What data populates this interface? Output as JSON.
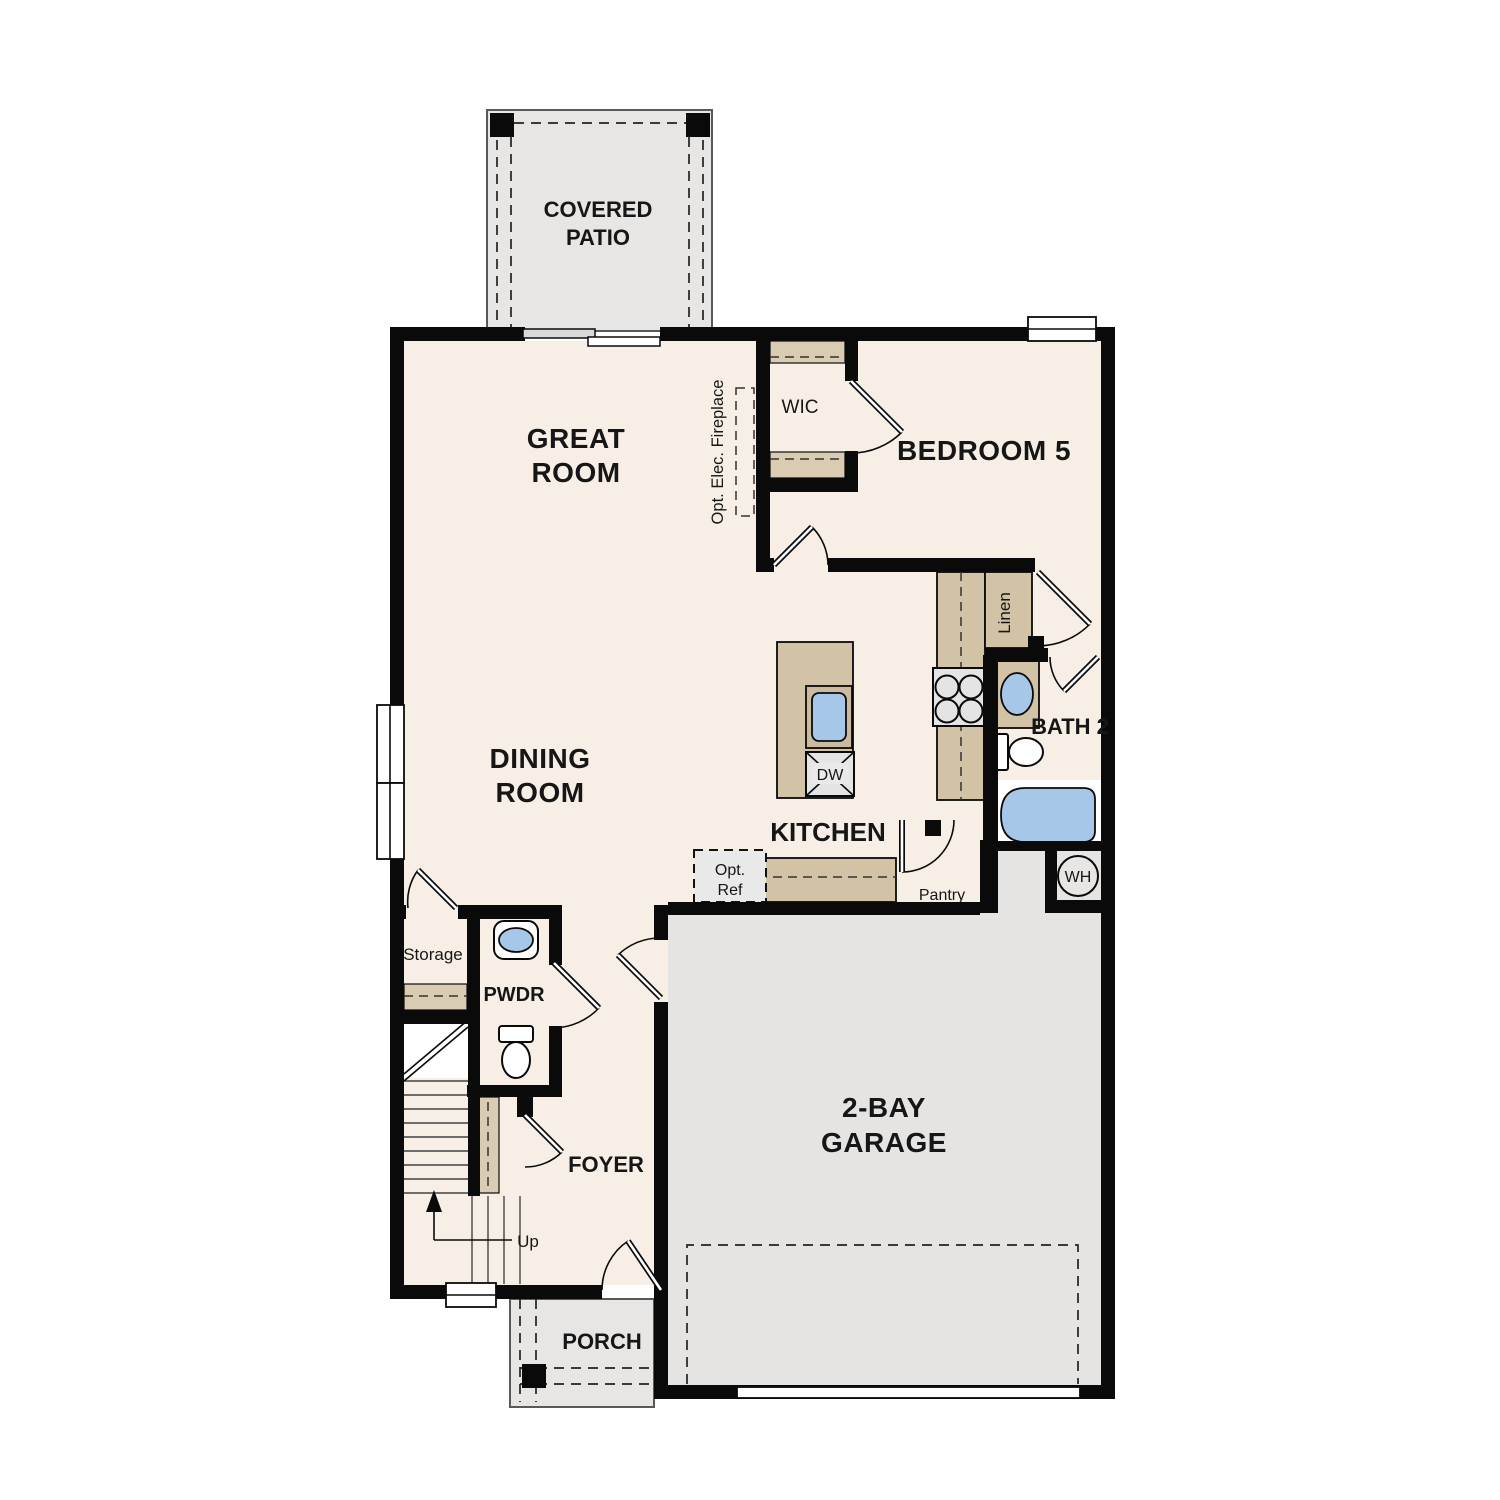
{
  "labels": {
    "covered_patio": {
      "line1": "COVERED",
      "line2": "PATIO"
    },
    "great_room": {
      "line1": "GREAT",
      "line2": "ROOM"
    },
    "wic": "WIC",
    "bedroom5": "BEDROOM 5",
    "fireplace": "Opt. Elec. Fireplace",
    "linen": "Linen",
    "bath2": "BATH 2",
    "dining_room": {
      "line1": "DINING",
      "line2": "ROOM"
    },
    "kitchen": "KITCHEN",
    "dishwasher": "DW",
    "water_heater": "WH",
    "opt_ref": {
      "line1": "Opt.",
      "line2": "Ref"
    },
    "pantry": "Pantry",
    "storage": "Storage",
    "pwdr": "PWDR",
    "foyer": "FOYER",
    "up": "Up",
    "garage": {
      "line1": "2-BAY",
      "line2": "GARAGE"
    },
    "porch": "PORCH"
  },
  "colors": {
    "wall": "#0a0a0a",
    "floor_cream": "#f7efe6",
    "concrete": "#e8e6e4",
    "garage": "#e6e4e2",
    "counter_tan": "#d2c3a6",
    "shelf_tan": "#d9ccb2",
    "fixture_blue": "#a6c7e8",
    "appliance_gray": "#e4e4e4"
  }
}
